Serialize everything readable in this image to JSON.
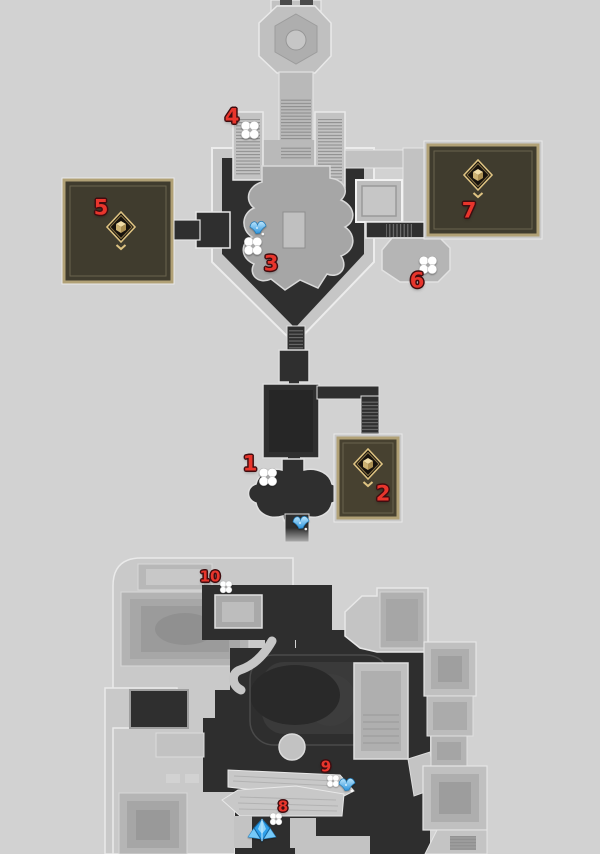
{
  "map": {
    "name": "game-area-map",
    "description": "Two-level game area map with numbered collectible markers",
    "colors": {
      "background": "#d2d2d2",
      "floor_dark": "#2f2f2f",
      "structure_light": "#c7c7c7",
      "structure_mid": "#b0b0b0",
      "outline": "#ececec",
      "gold_room_border": "#b1a176",
      "gold_room_floor": "#403c2e",
      "marker_red": "#e8352c",
      "marker_outline": "#400d10",
      "flower_white": "#ffffff",
      "bird_blue": "#4fb3f0",
      "chest_gold": "#dec382"
    },
    "numbered_markers": [
      {
        "label": "1",
        "x": 250,
        "y": 464,
        "size": "large"
      },
      {
        "label": "2",
        "x": 383,
        "y": 494,
        "size": "large"
      },
      {
        "label": "3",
        "x": 271,
        "y": 264,
        "size": "large"
      },
      {
        "label": "4",
        "x": 232,
        "y": 117,
        "size": "large"
      },
      {
        "label": "5",
        "x": 101,
        "y": 208,
        "size": "large"
      },
      {
        "label": "6",
        "x": 417,
        "y": 281,
        "size": "large"
      },
      {
        "label": "7",
        "x": 469,
        "y": 211,
        "size": "large"
      },
      {
        "label": "8",
        "x": 283,
        "y": 807,
        "size": "small"
      },
      {
        "label": "9",
        "x": 326,
        "y": 767,
        "size": "small"
      },
      {
        "label": "10",
        "x": 210,
        "y": 577,
        "size": "small"
      }
    ],
    "flower_markers": [
      {
        "x": 250,
        "y": 130,
        "scale": 1
      },
      {
        "x": 253,
        "y": 246,
        "scale": 1
      },
      {
        "x": 428,
        "y": 265,
        "scale": 1
      },
      {
        "x": 268,
        "y": 477,
        "scale": 1
      },
      {
        "x": 226,
        "y": 587,
        "scale": 0.68
      },
      {
        "x": 333,
        "y": 781,
        "scale": 0.68
      },
      {
        "x": 276,
        "y": 819,
        "scale": 0.68
      }
    ],
    "bird_markers": [
      {
        "x": 258,
        "y": 229,
        "scale": 1
      },
      {
        "x": 301,
        "y": 524,
        "scale": 1
      },
      {
        "x": 347,
        "y": 786,
        "scale": 1
      }
    ],
    "origami_markers": [
      {
        "x": 262,
        "y": 830,
        "scale": 1
      }
    ],
    "chest_markers": [
      {
        "x": 121,
        "y": 231,
        "scale": 1
      },
      {
        "x": 478,
        "y": 179,
        "scale": 1
      },
      {
        "x": 368,
        "y": 468,
        "scale": 1
      }
    ]
  }
}
